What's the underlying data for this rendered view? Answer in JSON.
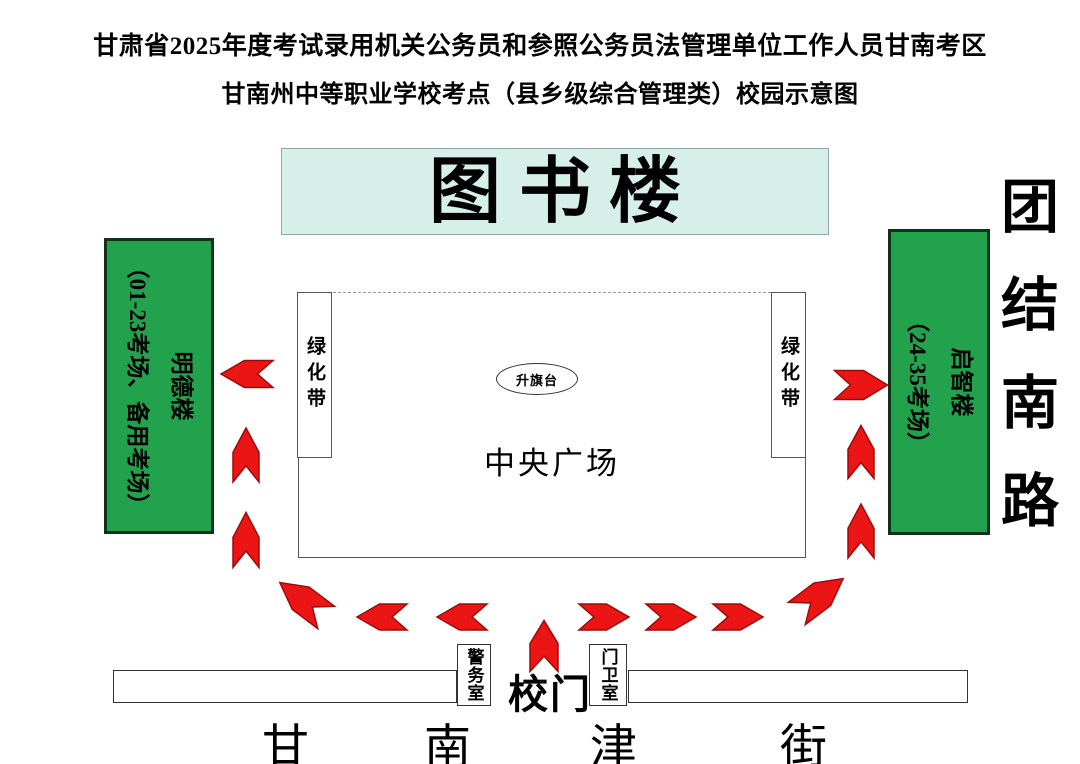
{
  "title": {
    "line1": "甘肃省2025年度考试录用机关公务员和参照公务员法管理单位工作人员甘南考区",
    "line2": "甘南州中等职业学校考点（县乡级综合管理类）校园示意图"
  },
  "library": {
    "label": "图书楼"
  },
  "buildings": {
    "left": {
      "name": "明德楼",
      "rooms": "（01-23考场、备用考场）"
    },
    "right": {
      "name": "启智楼",
      "rooms": "（24-35考场）"
    }
  },
  "roads": {
    "east": "团结南路",
    "south": "甘南津街",
    "south_chars": [
      "甘",
      "南",
      "津",
      "街"
    ]
  },
  "plaza": {
    "label": "中央广场",
    "flag_platform": "升旗台",
    "green_belt": "绿化带"
  },
  "gate": {
    "label": "校门",
    "police_room": "警务室",
    "guard_room": "门卫室"
  },
  "colors": {
    "building_green": "#22A24C",
    "building_border": "#0E3318",
    "library_mint": "#D7EFE9",
    "arrow_red": "#EC1515",
    "arrow_stroke": "#9E0B0B"
  },
  "arrows": [
    {
      "x": 247,
      "y": 374,
      "len": 52,
      "wid": 27,
      "rot": 180
    },
    {
      "x": 246,
      "y": 455,
      "len": 54,
      "wid": 26,
      "rot": -90
    },
    {
      "x": 246,
      "y": 540,
      "len": 55,
      "wid": 26,
      "rot": -90
    },
    {
      "x": 303,
      "y": 600,
      "len": 58,
      "wid": 28,
      "rot": 217
    },
    {
      "x": 382,
      "y": 617,
      "len": 50,
      "wid": 26,
      "rot": 180
    },
    {
      "x": 462,
      "y": 617,
      "len": 50,
      "wid": 26,
      "rot": 180
    },
    {
      "x": 544,
      "y": 646,
      "len": 51,
      "wid": 28,
      "rot": -90
    },
    {
      "x": 604,
      "y": 617,
      "len": 50,
      "wid": 26,
      "rot": 0
    },
    {
      "x": 671,
      "y": 617,
      "len": 50,
      "wid": 26,
      "rot": 0
    },
    {
      "x": 738,
      "y": 617,
      "len": 50,
      "wid": 26,
      "rot": 0
    },
    {
      "x": 820,
      "y": 596,
      "len": 58,
      "wid": 28,
      "rot": -37
    },
    {
      "x": 861,
      "y": 531,
      "len": 54,
      "wid": 26,
      "rot": -90
    },
    {
      "x": 861,
      "y": 452,
      "len": 53,
      "wid": 26,
      "rot": -90
    },
    {
      "x": 861,
      "y": 385,
      "len": 53,
      "wid": 29,
      "rot": 0
    }
  ]
}
